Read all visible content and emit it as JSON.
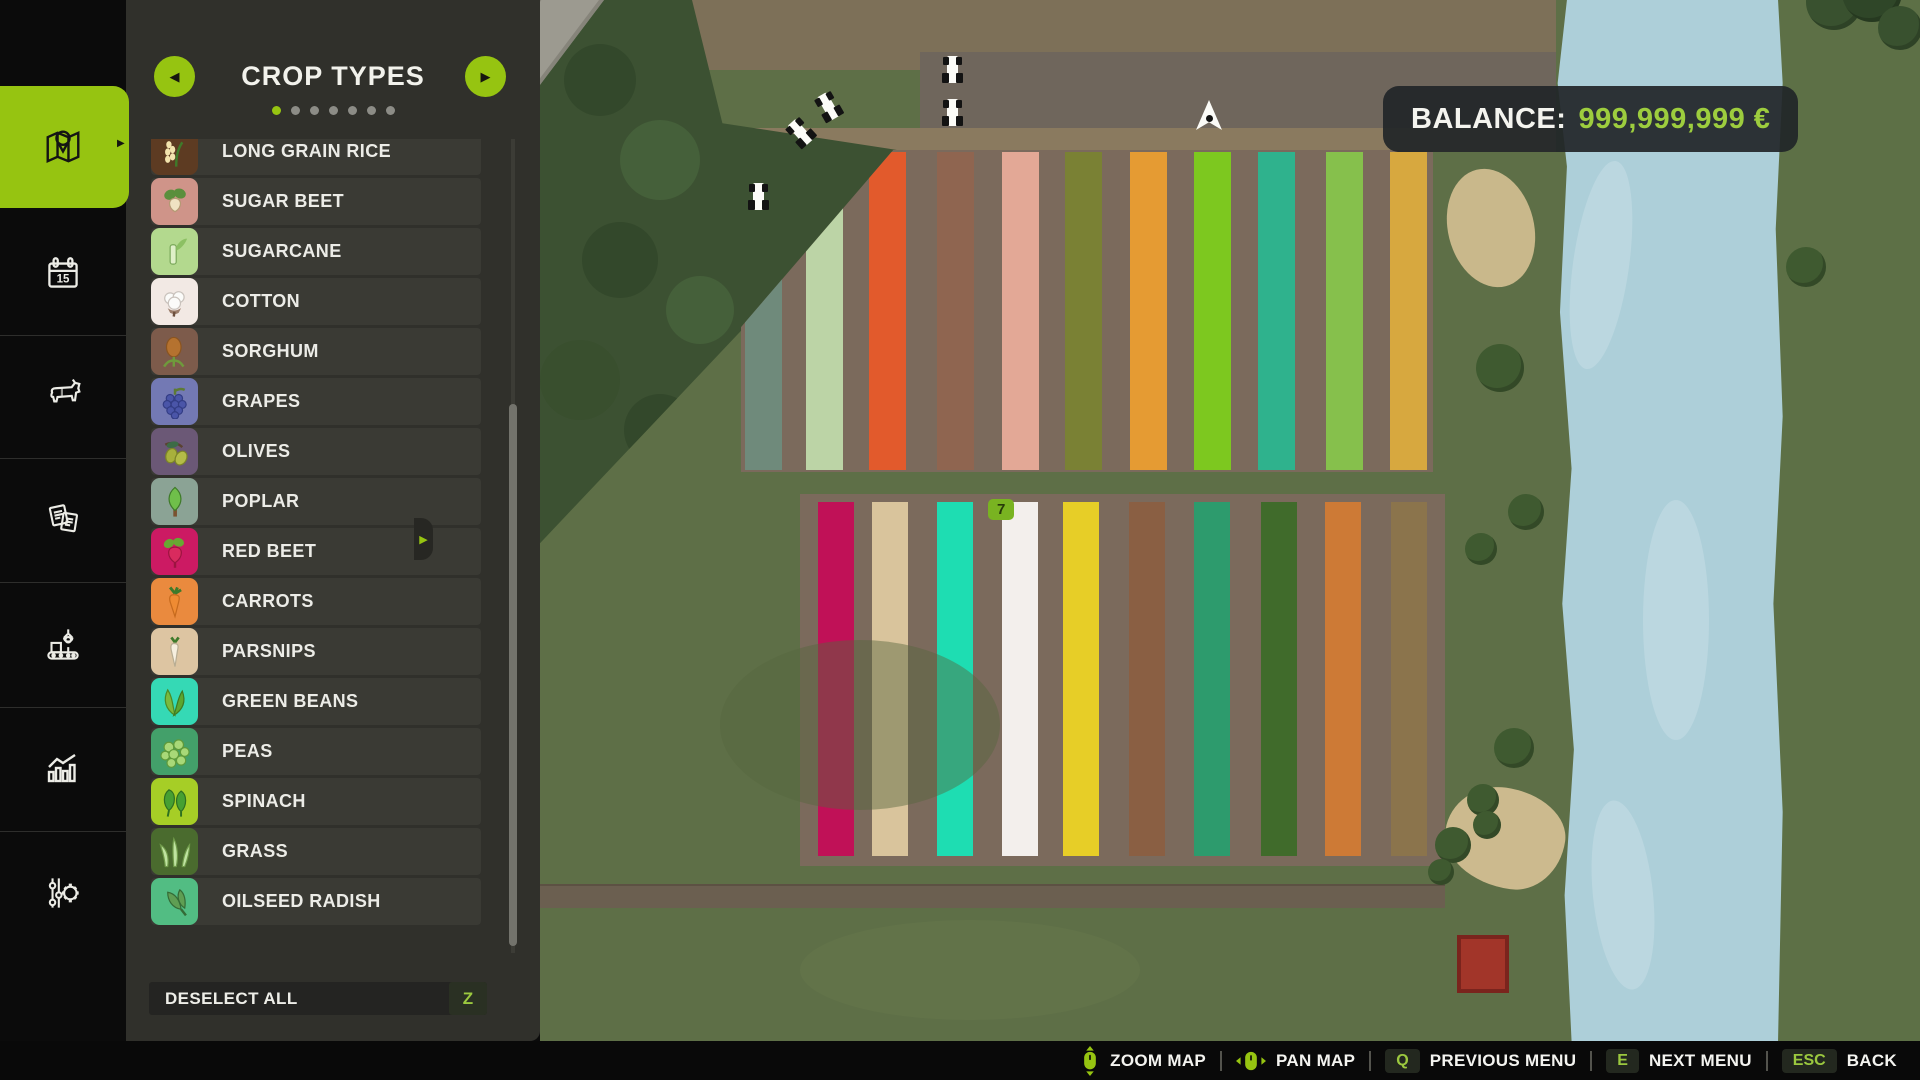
{
  "sidebar": {
    "items": [
      {
        "id": "map",
        "active": true
      },
      {
        "id": "calendar",
        "active": false
      },
      {
        "id": "animals",
        "active": false
      },
      {
        "id": "contracts",
        "active": false
      },
      {
        "id": "production",
        "active": false
      },
      {
        "id": "statistics",
        "active": false
      },
      {
        "id": "settings",
        "active": false
      }
    ],
    "calendar_day": "15"
  },
  "panel": {
    "title": "CROP TYPES",
    "page_dots": {
      "count": 7,
      "active_index": 0
    },
    "prev_arrow": "◀",
    "next_arrow": "▶",
    "crops": [
      {
        "label": "LONG GRAIN RICE",
        "icon_bg": "#5d3b22",
        "glyph": "rice"
      },
      {
        "label": "SUGAR BEET",
        "icon_bg": "#cf9489",
        "glyph": "sugarbeet"
      },
      {
        "label": "SUGARCANE",
        "icon_bg": "#b3d98e",
        "glyph": "sugarcane"
      },
      {
        "label": "COTTON",
        "icon_bg": "#f2e9e4",
        "glyph": "cotton"
      },
      {
        "label": "SORGHUM",
        "icon_bg": "#7d5b4b",
        "glyph": "sorghum"
      },
      {
        "label": "GRAPES",
        "icon_bg": "#7379b4",
        "glyph": "grapes"
      },
      {
        "label": "OLIVES",
        "icon_bg": "#6b5876",
        "glyph": "olives"
      },
      {
        "label": "POPLAR",
        "icon_bg": "#8ba395",
        "glyph": "poplar"
      },
      {
        "label": "RED BEET",
        "icon_bg": "#cc1a63",
        "glyph": "redbeet"
      },
      {
        "label": "CARROTS",
        "icon_bg": "#ea8a3e",
        "glyph": "carrot"
      },
      {
        "label": "PARSNIPS",
        "icon_bg": "#ddc5a2",
        "glyph": "parsnip"
      },
      {
        "label": "GREEN BEANS",
        "icon_bg": "#35d9b5",
        "glyph": "beans"
      },
      {
        "label": "PEAS",
        "icon_bg": "#43a06a",
        "glyph": "peas"
      },
      {
        "label": "SPINACH",
        "icon_bg": "#a6ce26",
        "glyph": "spinach"
      },
      {
        "label": "GRASS",
        "icon_bg": "#4a6b2e",
        "glyph": "grass"
      },
      {
        "label": "OILSEED RADISH",
        "icon_bg": "#52bd83",
        "glyph": "radish"
      }
    ],
    "deselect_all_label": "DESELECT ALL",
    "deselect_key": "Z"
  },
  "hud": {
    "balance_label": "BALANCE:",
    "balance_value": "999,999,999 €"
  },
  "map": {
    "field_top_strips": [
      "#6f8a7b",
      "#bcd4a6",
      "#e25a2c",
      "#8f6550",
      "#e3a896",
      "#7a8134",
      "#e59b33",
      "#7dc81f",
      "#2fb28d",
      "#86c04c",
      "#d7a83f"
    ],
    "field_bottom_strips": [
      "#c01157",
      "#d9c49c",
      "#1eddb2",
      "#f3efec",
      "#e7ce27",
      "#8a5f43",
      "#2d9b6d",
      "#406b2b",
      "#cd7a36",
      "#8b744c"
    ],
    "field_badge": "7",
    "vehicles": [
      {
        "type": "tractor",
        "x": 749,
        "y": 183,
        "rot": 0
      },
      {
        "type": "tractor",
        "x": 791,
        "y": 119,
        "rot": -42
      },
      {
        "type": "tractor",
        "x": 819,
        "y": 93,
        "rot": -30
      },
      {
        "type": "tractor",
        "x": 943,
        "y": 56,
        "rot": 0
      },
      {
        "type": "tractor",
        "x": 943,
        "y": 99,
        "rot": 0
      },
      {
        "type": "player-arrow",
        "x": 1196,
        "y": 100,
        "rot": 0
      }
    ]
  },
  "bottom_bar": {
    "items": [
      {
        "icon": "mouse-zoom-icon",
        "label": "ZOOM MAP"
      },
      {
        "icon": "mouse-pan-icon",
        "label": "PAN MAP"
      },
      {
        "key": "Q",
        "label": "PREVIOUS MENU"
      },
      {
        "key": "E",
        "label": "NEXT MENU"
      },
      {
        "key": "ESC",
        "label": "BACK"
      }
    ]
  },
  "colors": {
    "accent_green": "#96c411",
    "key_green": "#9bc83f",
    "balance_green": "#9dcd3e"
  }
}
